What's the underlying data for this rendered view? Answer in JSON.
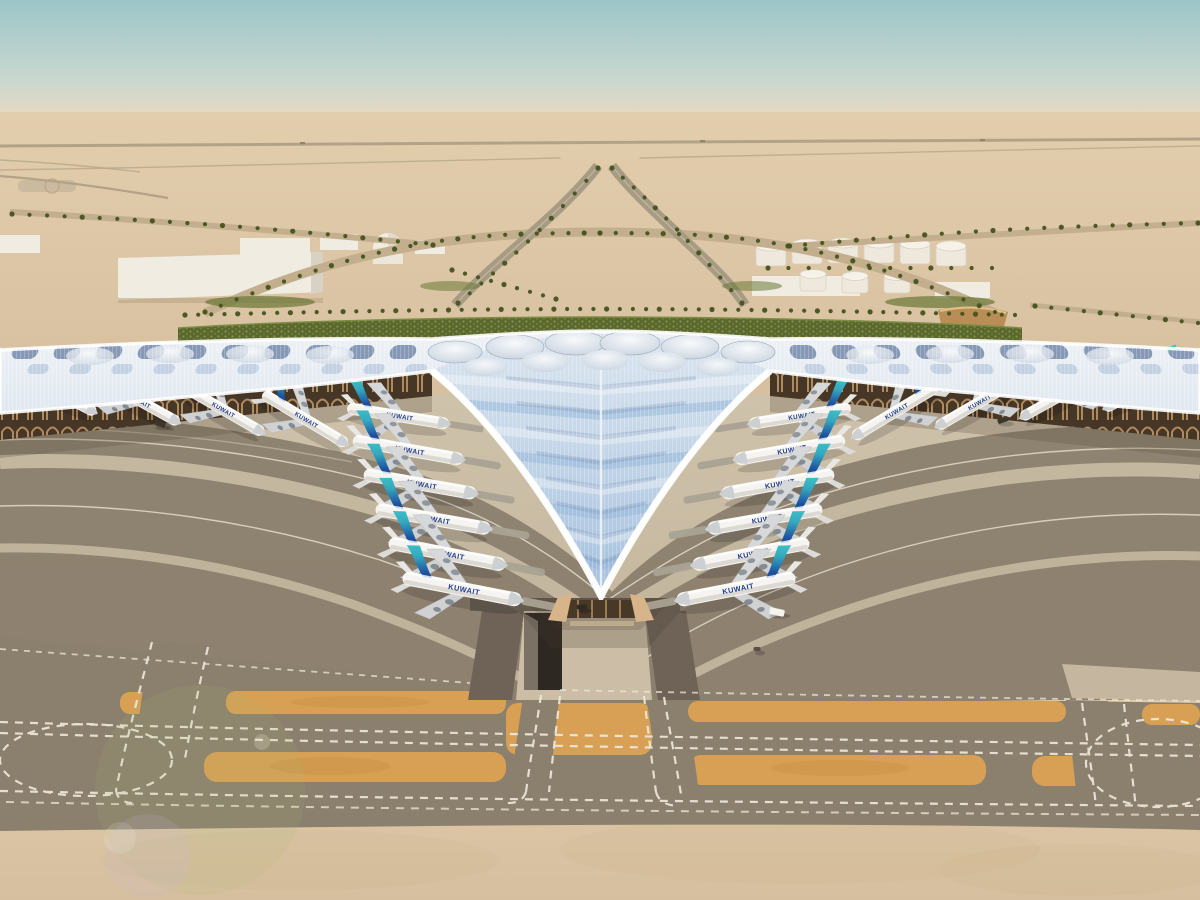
{
  "scene": {
    "description": "Aerial architectural rendering of a desert airport: a trefoil white ribbed terminal canopy with blue glazed skylights, Kuwait Airways jets parked at gates, palm-lined approach roads, fuel tanks and warehouses in the desert, and taxiways with orange blast pads and dashed white markings in the foreground."
  },
  "palette": {
    "sky_top": "#9cc5c8",
    "sky_mid": "#c7d7cf",
    "horizon": "#e9d9c2",
    "sand": "#e2cdad",
    "sand_deep": "#d6bf9e",
    "apron": "#c9bba2",
    "taxiway": "#8b7f6d",
    "pad_orange": "#d7a055",
    "roof_light": "#eef2f6",
    "roof_glaze": "#8fb3d8",
    "glaze_dark": "#6b82a6",
    "hedge": "#5a672f",
    "palm": "#46531f",
    "tail_teal": "#3fc2c6",
    "tail_blue": "#1d4f9e",
    "airline_navy": "#1f3d8c",
    "facade_tan": "#cfa36f",
    "facade_dark": "#463626",
    "building_white": "#f0ece1",
    "line_white": "#efe9da",
    "gold_ramp": "#b98d56"
  },
  "aircraft": {
    "airline_label": "KUWAIT",
    "count": 22,
    "positions": [
      {
        "x": 398,
        "y": 416,
        "r": 9,
        "s": 0.92,
        "m": false,
        "b": true
      },
      {
        "x": 408,
        "y": 450,
        "r": 10,
        "s": 1.0,
        "m": false,
        "b": true
      },
      {
        "x": 420,
        "y": 484,
        "r": 10,
        "s": 1.02,
        "m": false,
        "b": true
      },
      {
        "x": 433,
        "y": 519,
        "r": 10,
        "s": 1.04,
        "m": false,
        "b": true
      },
      {
        "x": 447,
        "y": 554,
        "r": 11,
        "s": 1.06,
        "m": false,
        "b": true
      },
      {
        "x": 462,
        "y": 589,
        "r": 11,
        "s": 1.08,
        "m": false,
        "b": true
      },
      {
        "x": 8,
        "y": 378,
        "r": 24,
        "s": 0.78,
        "m": false,
        "b": false
      },
      {
        "x": 55,
        "y": 392,
        "r": 27,
        "s": 0.82,
        "m": false,
        "b": false
      },
      {
        "x": 138,
        "y": 400,
        "r": 29,
        "s": 0.84,
        "m": false,
        "b": false
      },
      {
        "x": 222,
        "y": 409,
        "r": 30,
        "s": 0.86,
        "m": false,
        "b": false
      },
      {
        "x": 305,
        "y": 419,
        "r": 31,
        "s": 0.88,
        "m": false,
        "b": false
      },
      {
        "x": 800,
        "y": 416,
        "r": -9,
        "s": 0.92,
        "m": true,
        "b": true
      },
      {
        "x": 790,
        "y": 450,
        "r": -10,
        "s": 1.0,
        "m": true,
        "b": true
      },
      {
        "x": 778,
        "y": 484,
        "r": -10,
        "s": 1.02,
        "m": true,
        "b": true
      },
      {
        "x": 765,
        "y": 519,
        "r": -10,
        "s": 1.04,
        "m": true,
        "b": true
      },
      {
        "x": 751,
        "y": 554,
        "r": -11,
        "s": 1.06,
        "m": true,
        "b": true
      },
      {
        "x": 736,
        "y": 589,
        "r": -11,
        "s": 1.08,
        "m": true,
        "b": true
      },
      {
        "x": 1192,
        "y": 380,
        "r": -24,
        "s": 0.78,
        "m": true,
        "b": false
      },
      {
        "x": 1145,
        "y": 388,
        "r": -27,
        "s": 0.82,
        "m": true,
        "b": false
      },
      {
        "x": 1062,
        "y": 395,
        "r": -29,
        "s": 0.84,
        "m": true,
        "b": false
      },
      {
        "x": 978,
        "y": 403,
        "r": -30,
        "s": 0.86,
        "m": true,
        "b": false
      },
      {
        "x": 895,
        "y": 412,
        "r": -31,
        "s": 0.88,
        "m": true,
        "b": false
      }
    ]
  },
  "vehicles": [
    {
      "x": 777,
      "y": 612,
      "w": 15,
      "h": 7,
      "r": 12,
      "color": "#f5f3ee"
    },
    {
      "x": 757,
      "y": 649,
      "w": 7,
      "h": 4,
      "r": 0,
      "color": "#59513f"
    },
    {
      "x": 160,
      "y": 424,
      "w": 11,
      "h": 5,
      "r": 20,
      "color": "#3e362b"
    },
    {
      "x": 1003,
      "y": 420,
      "w": 11,
      "h": 5,
      "r": -20,
      "color": "#3e362b"
    },
    {
      "x": 582,
      "y": 607,
      "w": 10,
      "h": 5,
      "r": 0,
      "color": "#2f2a22"
    }
  ]
}
